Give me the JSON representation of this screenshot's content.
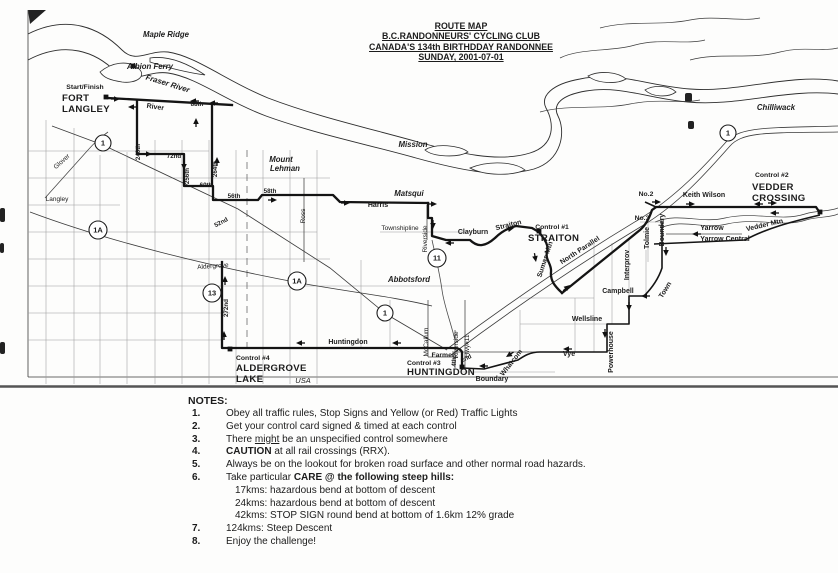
{
  "title": {
    "lines": [
      "ROUTE MAP",
      "B.C.RANDONNEURS' CYCLING CLUB",
      "CANADA'S 134th BIRTHDDAY RANDONNEE",
      "SUNDAY, 2001-07-01"
    ]
  },
  "map": {
    "labels": [
      {
        "t": "Maple Ridge",
        "x": 166,
        "y": 37,
        "cls": "pl"
      },
      {
        "t": "Albion Ferry",
        "x": 150,
        "y": 69,
        "cls": "pl"
      },
      {
        "t": "Fraser River",
        "x": 167,
        "y": 86,
        "rot": 17,
        "cls": "pl"
      },
      {
        "t": "Mission",
        "x": 413,
        "y": 147,
        "cls": "pl"
      },
      {
        "t": "Chilliwack",
        "x": 776,
        "y": 110,
        "cls": "pl"
      },
      {
        "t": "Abbotsford",
        "x": 409,
        "y": 282,
        "cls": "pl"
      },
      {
        "t": "Matsqui",
        "x": 409,
        "y": 196,
        "cls": "pl"
      },
      {
        "t": "Mount",
        "x": 281,
        "y": 162,
        "cls": "pl"
      },
      {
        "t": "Lehman",
        "x": 285,
        "y": 171,
        "cls": "pl"
      },
      {
        "t": "USA",
        "x": 303,
        "y": 383,
        "cls": "us"
      },
      {
        "t": "Start/Finish",
        "x": 85,
        "y": 89,
        "cls": "cs"
      },
      {
        "t": "FORT",
        "x": 62,
        "y": 101,
        "cls": "cb",
        "anc": "start"
      },
      {
        "t": "LANGLEY",
        "x": 62,
        "y": 112,
        "cls": "cb",
        "anc": "start"
      },
      {
        "t": "Control #1",
        "x": 552,
        "y": 229,
        "cls": "cs"
      },
      {
        "t": "STRAITON",
        "x": 528,
        "y": 241,
        "cls": "cb",
        "anc": "start"
      },
      {
        "t": "Control #2",
        "x": 755,
        "y": 177,
        "cls": "cs",
        "anc": "start"
      },
      {
        "t": "VEDDER",
        "x": 752,
        "y": 190,
        "cls": "cb",
        "anc": "start"
      },
      {
        "t": "CROSSING",
        "x": 752,
        "y": 201,
        "cls": "cb",
        "anc": "start"
      },
      {
        "t": "Control #3",
        "x": 407,
        "y": 365,
        "cls": "cs",
        "anc": "start"
      },
      {
        "t": "HUNTINGDON",
        "x": 407,
        "y": 375,
        "cls": "cb",
        "anc": "start"
      },
      {
        "t": "Control #4",
        "x": 236,
        "y": 360,
        "cls": "cs",
        "anc": "start"
      },
      {
        "t": "ALDERGROVE",
        "x": 236,
        "y": 371,
        "cls": "cb",
        "anc": "start"
      },
      {
        "t": "LAKE",
        "x": 236,
        "y": 382,
        "cls": "cb",
        "anc": "start"
      },
      {
        "t": "No.2",
        "x": 646,
        "y": 196,
        "cls": "cs"
      },
      {
        "t": "No.3",
        "x": 642,
        "y": 220,
        "cls": "cs"
      },
      {
        "t": "Farmer",
        "x": 443,
        "y": 357,
        "cls": "cs"
      },
      {
        "t": "River",
        "x": 155,
        "y": 109,
        "rot": 8,
        "cls": "rd"
      },
      {
        "t": "Harris",
        "x": 378,
        "y": 207,
        "cls": "rd"
      },
      {
        "t": "Clayburn",
        "x": 473,
        "y": 234,
        "cls": "rd"
      },
      {
        "t": "Straiton",
        "x": 509,
        "y": 227,
        "rot": -14,
        "cls": "rd"
      },
      {
        "t": "Sumas Mtn",
        "x": 547,
        "y": 260,
        "rot": -72,
        "cls": "rd"
      },
      {
        "t": "North Parallel",
        "x": 581,
        "y": 252,
        "rot": -33,
        "cls": "rd"
      },
      {
        "t": "Keith Wilson",
        "x": 704,
        "y": 197,
        "cls": "rd"
      },
      {
        "t": "Yarrow",
        "x": 712,
        "y": 230,
        "cls": "rd"
      },
      {
        "t": "Yarrow Central",
        "x": 725,
        "y": 241,
        "cls": "rd"
      },
      {
        "t": "Vedder Mtn",
        "x": 765,
        "y": 227,
        "rot": -13,
        "cls": "rd"
      },
      {
        "t": "Huntingdon",
        "x": 348,
        "y": 344,
        "cls": "rd"
      },
      {
        "t": "Campbell",
        "x": 618,
        "y": 293,
        "cls": "rd"
      },
      {
        "t": "Wellsline",
        "x": 587,
        "y": 321,
        "cls": "rd"
      },
      {
        "t": "Vye",
        "x": 569,
        "y": 356,
        "cls": "rd"
      },
      {
        "t": "Whatcom",
        "x": 513,
        "y": 364,
        "rot": -52,
        "cls": "rd"
      },
      {
        "t": "Boundary",
        "x": 492,
        "y": 381,
        "cls": "rd"
      },
      {
        "t": "Powerhouse",
        "x": 613,
        "y": 352,
        "rot": -90,
        "cls": "rd"
      },
      {
        "t": "Interprov",
        "x": 629,
        "y": 265,
        "rot": -90,
        "cls": "rd"
      },
      {
        "t": "Town",
        "x": 667,
        "y": 291,
        "rot": -58,
        "cls": "rd"
      },
      {
        "t": "Tolmie",
        "x": 649,
        "y": 238,
        "rot": -90,
        "cls": "rd"
      },
      {
        "t": "Boundary",
        "x": 664,
        "y": 230,
        "rot": -90,
        "cls": "rd"
      },
      {
        "t": "Glover",
        "x": 63,
        "y": 163,
        "rot": -42,
        "cls": "rp"
      },
      {
        "t": "Langley",
        "x": 57,
        "y": 201,
        "cls": "rp"
      },
      {
        "t": "Ross",
        "x": 305,
        "y": 216,
        "rot": -90,
        "cls": "rp"
      },
      {
        "t": "Aldergrove",
        "x": 213,
        "y": 268,
        "rot": -4,
        "cls": "rp"
      },
      {
        "t": "Townshipline",
        "x": 400,
        "y": 230,
        "cls": "rp"
      },
      {
        "t": "Riverside",
        "x": 427,
        "y": 239,
        "rot": -90,
        "cls": "rp"
      },
      {
        "t": "McCallum",
        "x": 428,
        "y": 342,
        "rot": -90,
        "cls": "rp"
      },
      {
        "t": "Riverside",
        "x": 458,
        "y": 345,
        "rot": -90,
        "cls": "rp"
      },
      {
        "t": "Hwy#11",
        "x": 469,
        "y": 346,
        "rot": -90,
        "cls": "rp"
      },
      {
        "t": "88th",
        "x": 197,
        "y": 106,
        "cls": "st"
      },
      {
        "t": "240th",
        "x": 140,
        "y": 152,
        "rot": -90,
        "cls": "st"
      },
      {
        "t": "72nd",
        "x": 174,
        "y": 158,
        "cls": "st"
      },
      {
        "t": "256th",
        "x": 189,
        "y": 176,
        "rot": -90,
        "cls": "st"
      },
      {
        "t": "264th",
        "x": 217,
        "y": 169,
        "rot": -90,
        "cls": "st"
      },
      {
        "t": "60th",
        "x": 206,
        "y": 187,
        "cls": "st"
      },
      {
        "t": "56th",
        "x": 234,
        "y": 198,
        "cls": "st"
      },
      {
        "t": "58th",
        "x": 270,
        "y": 193,
        "cls": "st"
      },
      {
        "t": "52nd",
        "x": 222,
        "y": 224,
        "rot": -28,
        "cls": "st"
      },
      {
        "t": "272nd",
        "x": 228,
        "y": 308,
        "rot": -90,
        "cls": "st"
      },
      {
        "t": "2nd",
        "x": 467,
        "y": 360,
        "rot": -25,
        "cls": "st"
      },
      {
        "t": "4th",
        "x": 456,
        "y": 362,
        "rot": -90,
        "cls": "st"
      }
    ],
    "markers": [
      {
        "t": "1",
        "x": 103,
        "y": 143,
        "r": 8
      },
      {
        "t": "1",
        "x": 385,
        "y": 313,
        "r": 8
      },
      {
        "t": "1",
        "x": 728,
        "y": 133,
        "r": 8
      },
      {
        "t": "1A",
        "x": 98,
        "y": 230,
        "r": 9
      },
      {
        "t": "1A",
        "x": 297,
        "y": 281,
        "r": 9
      },
      {
        "t": "13",
        "x": 212,
        "y": 293,
        "r": 9
      },
      {
        "t": "11",
        "x": 437,
        "y": 258,
        "r": 9
      }
    ],
    "arrows": [
      {
        "x": 120,
        "y": 99,
        "r": 0
      },
      {
        "x": 128,
        "y": 107,
        "r": 180
      },
      {
        "x": 190,
        "y": 101,
        "r": 180
      },
      {
        "x": 209,
        "y": 103,
        "r": 180
      },
      {
        "x": 196,
        "y": 118,
        "r": -90
      },
      {
        "x": 152,
        "y": 154,
        "r": 0
      },
      {
        "x": 184,
        "y": 170,
        "r": 90
      },
      {
        "x": 217,
        "y": 157,
        "r": -90
      },
      {
        "x": 277,
        "y": 200,
        "r": 0
      },
      {
        "x": 350,
        "y": 203,
        "r": 0
      },
      {
        "x": 437,
        "y": 204,
        "r": 0
      },
      {
        "x": 433,
        "y": 229,
        "r": 90
      },
      {
        "x": 445,
        "y": 243,
        "r": 180
      },
      {
        "x": 514,
        "y": 228,
        "r": -12
      },
      {
        "x": 536,
        "y": 262,
        "r": 80
      },
      {
        "x": 570,
        "y": 285,
        "r": -40
      },
      {
        "x": 661,
        "y": 202,
        "r": 0
      },
      {
        "x": 695,
        "y": 204,
        "r": 0
      },
      {
        "x": 754,
        "y": 204,
        "r": 180
      },
      {
        "x": 777,
        "y": 203,
        "r": 0
      },
      {
        "x": 770,
        "y": 213,
        "r": 180
      },
      {
        "x": 692,
        "y": 234,
        "r": 180
      },
      {
        "x": 666,
        "y": 256,
        "r": 90
      },
      {
        "x": 641,
        "y": 296,
        "r": 180
      },
      {
        "x": 629,
        "y": 311,
        "r": 90
      },
      {
        "x": 605,
        "y": 338,
        "r": 90
      },
      {
        "x": 563,
        "y": 349,
        "r": 180
      },
      {
        "x": 506,
        "y": 357,
        "r": 147
      },
      {
        "x": 479,
        "y": 366,
        "r": 180
      },
      {
        "x": 296,
        "y": 343,
        "r": 180
      },
      {
        "x": 392,
        "y": 343,
        "r": 180
      },
      {
        "x": 224,
        "y": 331,
        "r": -90
      },
      {
        "x": 225,
        "y": 276,
        "r": -90
      }
    ],
    "control_dots": [
      {
        "x": 106,
        "y": 97
      },
      {
        "x": 539,
        "y": 231
      },
      {
        "x": 820,
        "y": 212
      },
      {
        "x": 462,
        "y": 367
      },
      {
        "x": 230,
        "y": 349
      },
      {
        "x": 133,
        "y": 66
      }
    ]
  },
  "notes": {
    "heading": "NOTES:",
    "items": [
      {
        "num": "1.",
        "parts": [
          {
            "t": "Obey all traffic rules, Stop Signs and Yellow (or Red) Traffic Lights"
          }
        ]
      },
      {
        "num": "2.",
        "parts": [
          {
            "t": "Get your control card signed & timed at each control"
          }
        ]
      },
      {
        "num": "3.",
        "parts": [
          {
            "t": "There "
          },
          {
            "t": "might",
            "u": 1
          },
          {
            "t": " be an unspecified control somewhere"
          }
        ]
      },
      {
        "num": "4.",
        "parts": [
          {
            "t": "CAUTION",
            "b": 1
          },
          {
            "t": " at all rail crossings (RRX)."
          }
        ]
      },
      {
        "num": "5.",
        "parts": [
          {
            "t": "Always be on the lookout for broken road surface and other normal road hazards."
          }
        ]
      },
      {
        "num": "6.",
        "parts": [
          {
            "t": "Take particular "
          },
          {
            "t": "CARE @ the following steep hills:",
            "b": 1
          }
        ],
        "subitems": [
          "17kms: hazardous bend at bottom of descent",
          "24kms: hazardous bend at bottom of descent",
          "42kms: STOP SIGN round bend at bottom of 1.6km 12% grade"
        ]
      },
      {
        "num": "7.",
        "parts": [
          {
            "t": "124kms: Steep Descent"
          }
        ]
      },
      {
        "num": "8.",
        "parts": [
          {
            "t": "Enjoy the challenge!"
          }
        ]
      }
    ]
  }
}
